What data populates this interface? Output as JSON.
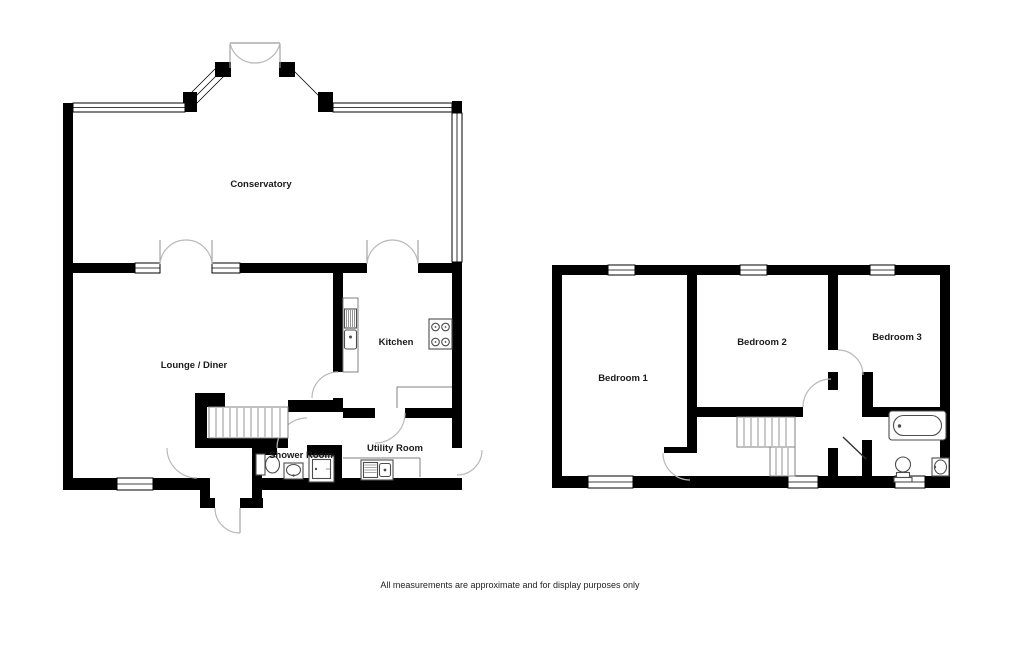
{
  "colors": {
    "wall": "#000000",
    "background": "#ffffff",
    "door_swing": "#b9b9b9",
    "fixture_line": "#4d4d4d",
    "stair_line": "#808080"
  },
  "ground_floor": {
    "rooms": {
      "conservatory": "Conservatory",
      "lounge_diner": "Lounge / Diner",
      "kitchen": "Kitchen",
      "shower_room": "Shower Room",
      "utility_room": "Utility Room"
    },
    "fixtures": [
      "staircase",
      "kitchen-sink",
      "hob",
      "worktop",
      "utility-sink",
      "toilet",
      "basin",
      "shower"
    ]
  },
  "first_floor": {
    "rooms": {
      "bedroom_1": "Bedroom 1",
      "bedroom_2": "Bedroom 2",
      "bedroom_3": "Bedroom 3"
    },
    "fixtures": [
      "staircase",
      "bath",
      "toilet",
      "basin"
    ]
  },
  "footer": {
    "disclaimer": "All measurements are approximate and for display purposes only"
  }
}
